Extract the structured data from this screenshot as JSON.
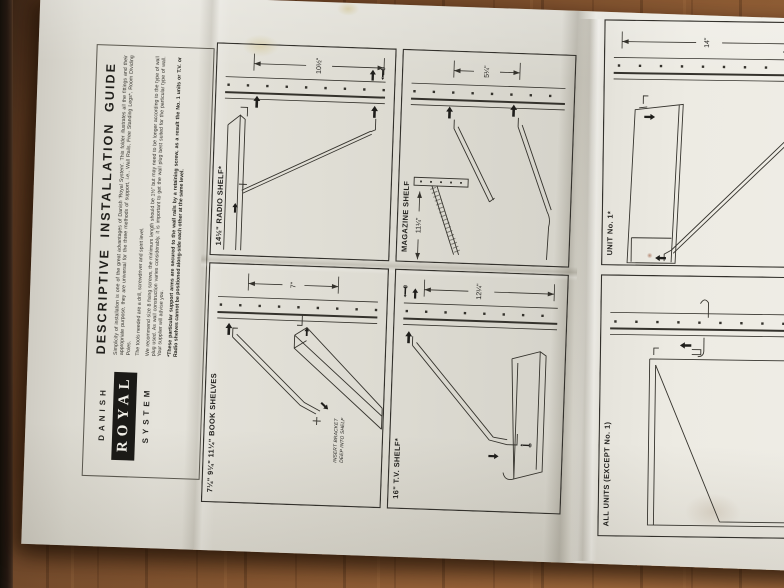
{
  "colors": {
    "wood_dark": "#54351f",
    "wood_mid": "#7c4e2b",
    "wood_light": "#a26a3e",
    "paper": "#e2e0d8",
    "paper_shadow": "#cfccc3",
    "ink": "#2c2a26",
    "logo_box": "#1b1a17"
  },
  "cover": {
    "brand_top": "DANISH",
    "brand_middle": "ROYAL",
    "brand_bottom": "SYSTEM",
    "title": "DESCRIPTIVE INSTALLATION GUIDE",
    "paragraphs": [
      "Simplicity of installation is one of the great advantages of Danish 'Royal System'. This folder illustrates all the fittings and their appropriate purpose, they are universal for the three methods of support, i.e., Wall Rails, Free Standing Legs*, Room Dividing Poles.",
      "The tools needed are a drill, screwdriver and spirit level.",
      "We recommend size 8 fixing screws, the minimum length should be 1½\" but may need to be longer according to the type of wall plug used. As wall construction varies considerably, it is important to get the wall plug best suited for the particular type of wall. Your supplier will advise you.",
      "*These particular support arms are secured to the wall rails by a retaining screw, as a result the No. 1 units or T.V. or Radio shelves cannot be positioned along-side each other at the same level."
    ]
  },
  "panels": [
    {
      "label": "14½\" RADIO SHELF*",
      "dimension": "10½\""
    },
    {
      "label": "MAGAZINE SHELF",
      "dimension": "5¼\"",
      "drop_dimension": "11¼\""
    },
    {
      "label": "7¼\" 9¼\" 11¼\" BOOK SHELVES",
      "dimension": "7\"",
      "note_line1": "INSERT BRACKET",
      "note_line2": "DEEP INTO SHELF"
    },
    {
      "label": "16\" T.V. SHELF*",
      "dimension": "12¼\""
    },
    {
      "label": "UNIT No. 1*",
      "dimension": "14\""
    },
    {
      "label": "ALL UNITS (EXCEPT No. 1)"
    }
  ]
}
